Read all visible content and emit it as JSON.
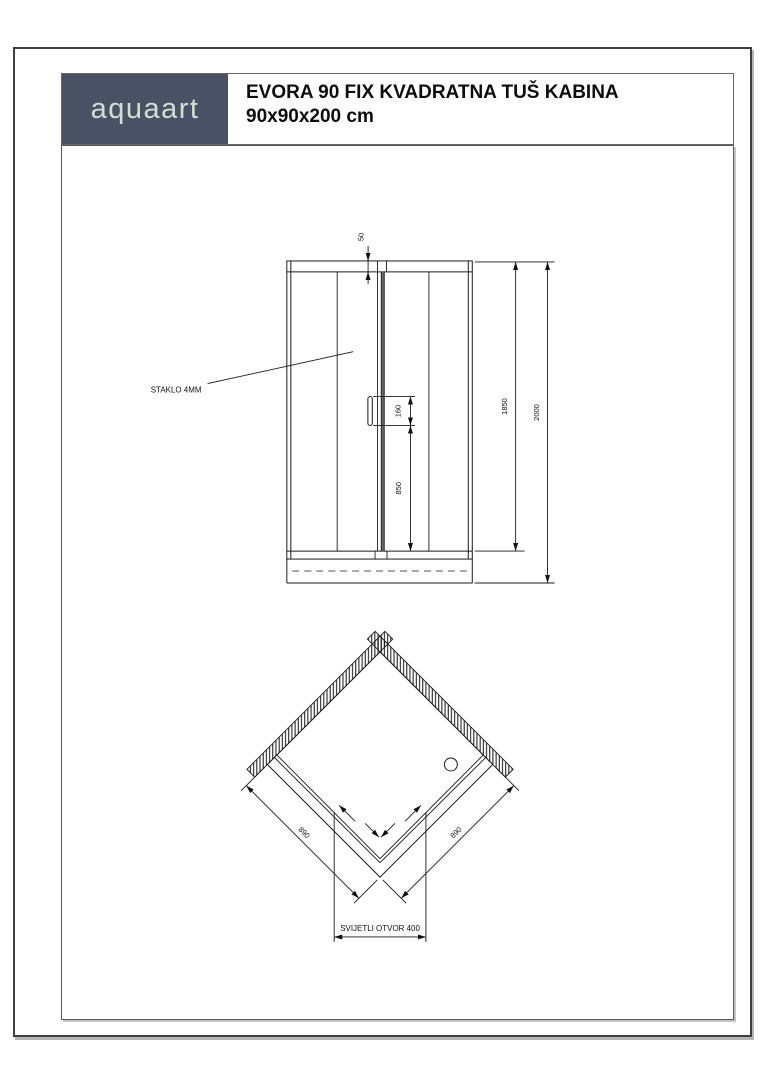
{
  "header": {
    "brand": "aquaart",
    "title_line1": "EVORA 90 FIX KVADRATNA TUŠ KABINA",
    "title_line2": "90x90x200 cm"
  },
  "colors": {
    "brand_bg": "#4a5164",
    "brand_text": "#cfe0d3",
    "line": "#1a1a1a"
  },
  "front_view": {
    "glass_label": "STAKLO 4MM",
    "dim_top_profile": "50",
    "dim_handle_length": "160",
    "dim_handle_height": "850",
    "dim_glass_height": "1850",
    "dim_total_height": "2000"
  },
  "top_view": {
    "dim_side_left": "890",
    "dim_side_right": "890",
    "dim_clear_opening": "SVIJETLI OTVOR 400"
  }
}
